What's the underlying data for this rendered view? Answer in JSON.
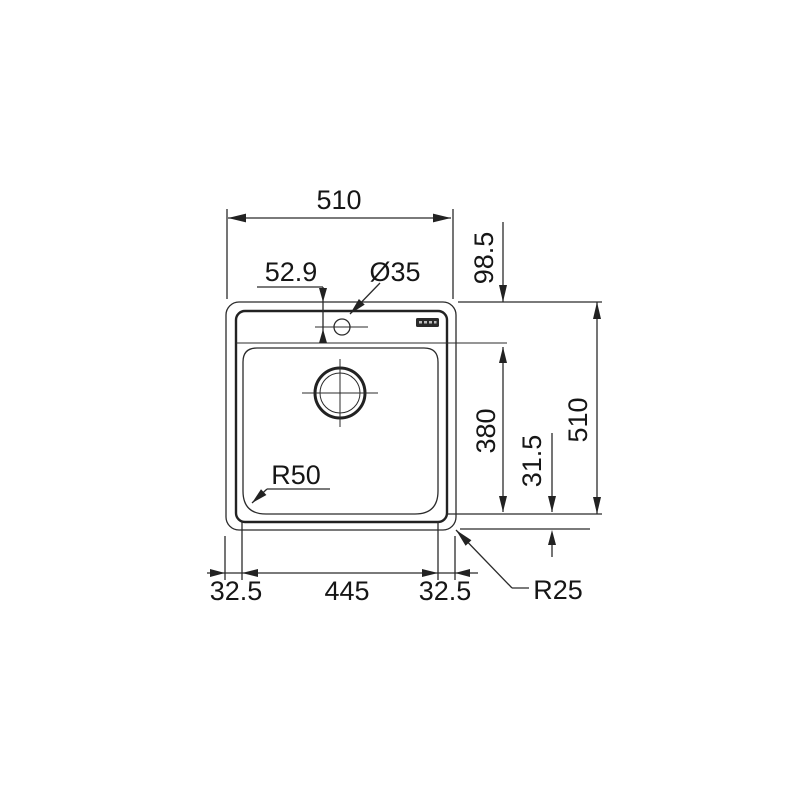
{
  "drawing": {
    "type": "sink-installation-dimension-drawing",
    "units": "mm",
    "labels": {
      "overall_width": "510",
      "overall_depth": "510",
      "tap_ledge_depth": "98.5",
      "tap_hole_offset": "52.9",
      "tap_hole_diameter": "Ø35",
      "bowl_depth": "380",
      "bowl_to_edge_offset": "31.5",
      "bowl_corner_radius": "R50",
      "bowl_width": "445",
      "left_edge_width": "32.5",
      "right_edge_width": "32.5",
      "outer_corner_radius": "R25"
    },
    "colors": {
      "line": "#2b2b2b",
      "text": "#161616",
      "background": "#ffffff",
      "logo_block": "#2a2a2a"
    }
  }
}
